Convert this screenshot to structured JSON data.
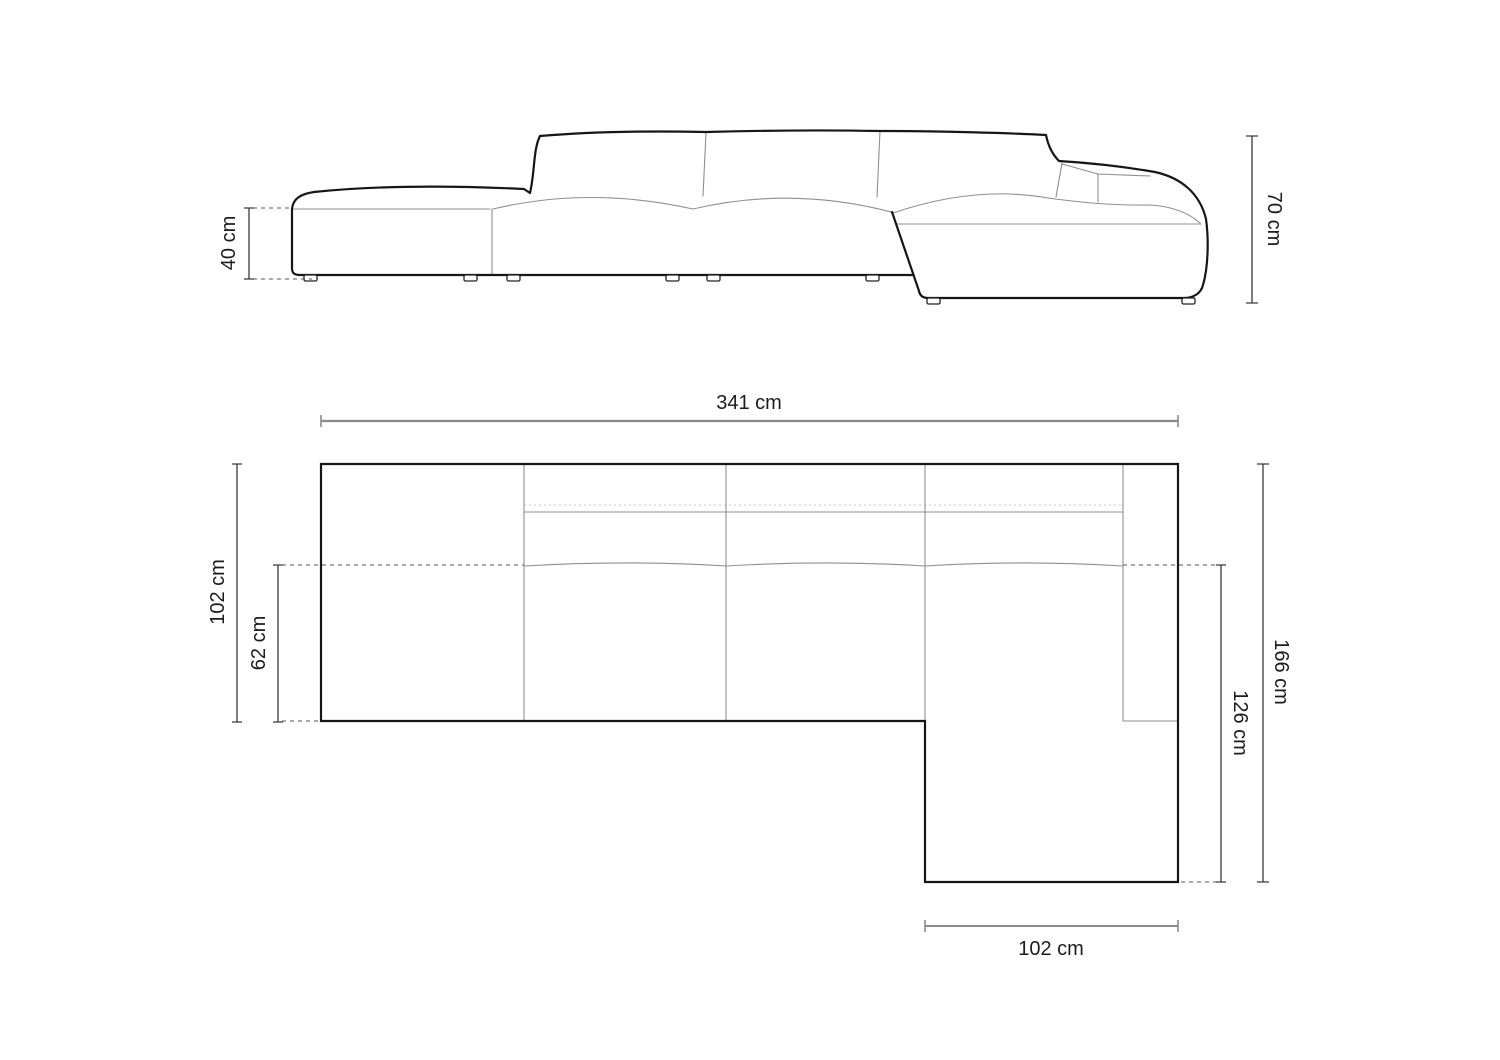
{
  "diagram": {
    "type": "furniture-dimension-drawing",
    "subject": "modular corner sofa with left open end and right chaise",
    "views": {
      "front_view": {
        "name": "front elevation",
        "dimensions": {
          "seat_height": {
            "label": "40 cm",
            "orientation": "vertical-left"
          },
          "total_height": {
            "label": "70 cm",
            "orientation": "vertical-right"
          }
        }
      },
      "top_view": {
        "name": "top plan",
        "dimensions": {
          "total_width": {
            "label": "341 cm",
            "orientation": "horizontal-top"
          },
          "total_depth": {
            "label": "102 cm",
            "orientation": "vertical-left"
          },
          "seat_depth": {
            "label": "62 cm",
            "orientation": "vertical-left-inner"
          },
          "right_total_depth": {
            "label": "166 cm",
            "orientation": "vertical-right"
          },
          "chaise_depth": {
            "label": "126 cm",
            "orientation": "vertical-right-inner"
          },
          "chaise_width": {
            "label": "102 cm",
            "orientation": "horizontal-bottom"
          }
        }
      }
    },
    "colors": {
      "background": "#ffffff",
      "outline": "#161616",
      "seam": "#8f8f8f",
      "faint_dotted": "#c9c9c9",
      "dashed_extension": "#555555",
      "dimension_dark": "#3a3a3a",
      "dimension_gray": "#8a8a8a",
      "text": "#1c1c1c"
    }
  }
}
